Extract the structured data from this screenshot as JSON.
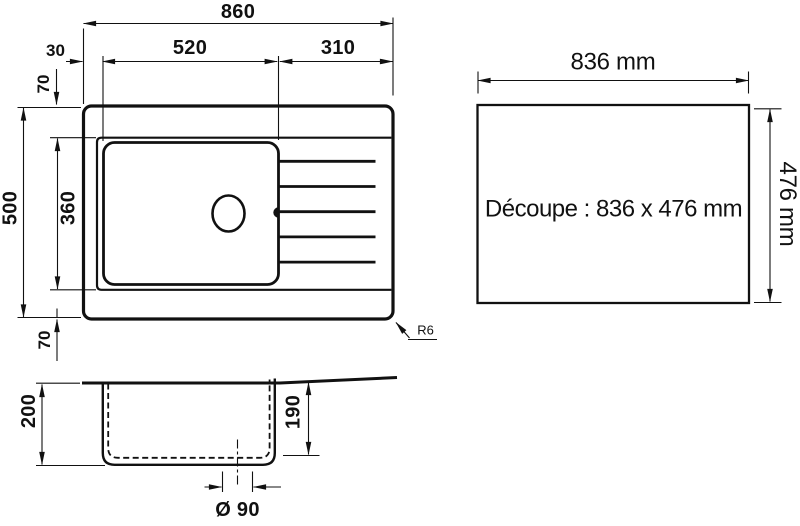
{
  "labels": {
    "top_view": {
      "width_total": "860",
      "width_left_offset": "30",
      "width_bowl": "520",
      "width_drainer": "310",
      "height_total": "500",
      "height_bowl": "360",
      "margin_top": "70",
      "margin_bottom": "70",
      "corner_radius": "R6"
    },
    "cutout_panel": {
      "width": "836 mm",
      "height": "476 mm",
      "caption": "Découpe : 836 x 476 mm"
    },
    "section_view": {
      "depth_total": "200",
      "depth_bowl": "190",
      "drain_diameter": "Ø 90"
    }
  },
  "colors": {
    "ink": "#111111",
    "background": "#ffffff"
  }
}
